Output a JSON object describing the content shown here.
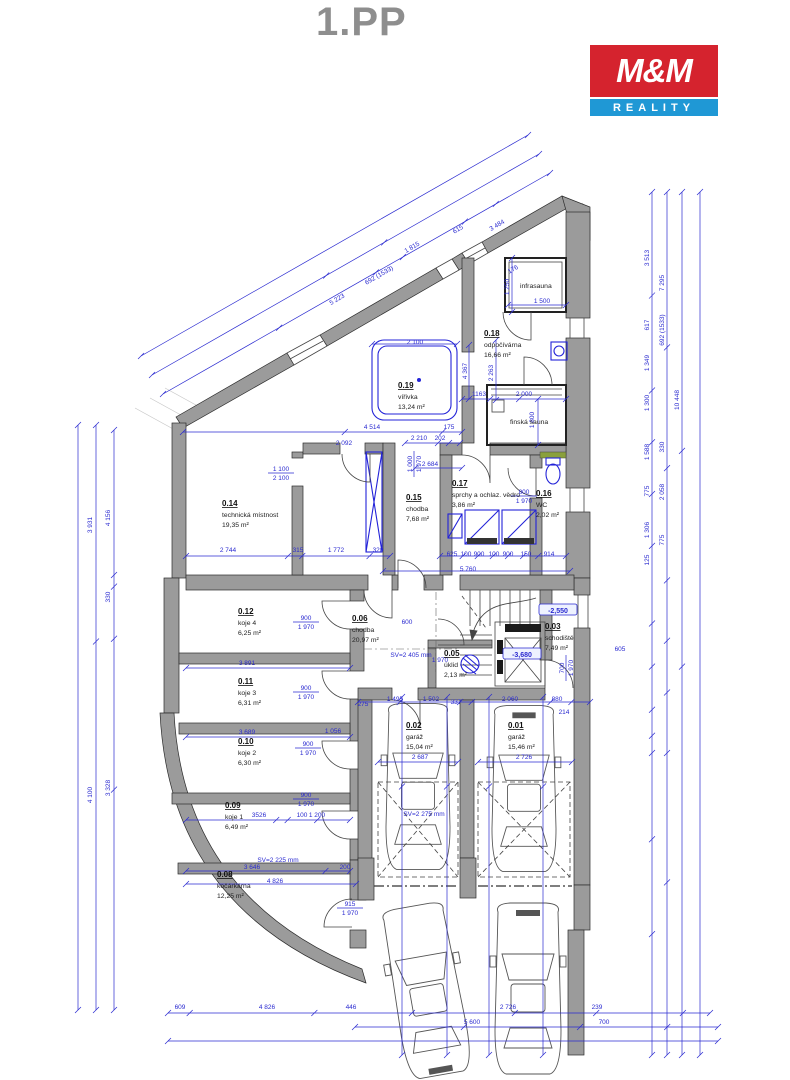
{
  "title": "1.PP",
  "logo": {
    "top": "M&M",
    "bottom": "REALITY",
    "red": "#d5232e",
    "blue": "#1f98d5"
  },
  "colors": {
    "wall": "#9b9b9b",
    "dimension": "#2a2ad0"
  },
  "rooms": [
    {
      "num": "0.19",
      "name": "vířivka",
      "area": "13,24 m²",
      "x": 398,
      "y": 388
    },
    {
      "num": "0.18",
      "name": "odpočívárna",
      "area": "16,66 m²",
      "x": 484,
      "y": 336
    },
    {
      "num": "",
      "name": "infrasauna",
      "area": "",
      "x": 520,
      "y": 288
    },
    {
      "num": "",
      "name": "finská sauna",
      "area": "",
      "x": 510,
      "y": 424
    },
    {
      "num": "0.14",
      "name": "technická místnost",
      "area": "19,35 m²",
      "x": 222,
      "y": 506
    },
    {
      "num": "0.15",
      "name": "chodba",
      "area": "7,68 m²",
      "x": 406,
      "y": 500
    },
    {
      "num": "0.17",
      "name": "sprchy a ochlaz. vědro",
      "area": "3,86 m²",
      "x": 452,
      "y": 486
    },
    {
      "num": "0.16",
      "name": "WC",
      "area": "2,02 m²",
      "x": 536,
      "y": 496
    },
    {
      "num": "0.12",
      "name": "koje 4",
      "area": "6,25 m²",
      "x": 238,
      "y": 614
    },
    {
      "num": "0.11",
      "name": "koje 3",
      "area": "6,31 m²",
      "x": 238,
      "y": 684
    },
    {
      "num": "0.10",
      "name": "koje 2",
      "area": "6,30 m²",
      "x": 238,
      "y": 744
    },
    {
      "num": "0.09",
      "name": "koje 1",
      "area": "6,49 m²",
      "x": 225,
      "y": 808
    },
    {
      "num": "0.08",
      "name": "kočárkárna",
      "area": "12,25 m²",
      "x": 217,
      "y": 877
    },
    {
      "num": "0.06",
      "name": "chodba",
      "area": "20,97 m²",
      "x": 352,
      "y": 621
    },
    {
      "num": "0.05",
      "name": "úklid",
      "area": "2,13 m²",
      "x": 444,
      "y": 656
    },
    {
      "num": "0.03",
      "name": "schodiště",
      "area": "7,49 m²",
      "x": 545,
      "y": 629
    },
    {
      "num": "0.02",
      "name": "garáž",
      "area": "15,04 m²",
      "x": 406,
      "y": 728
    },
    {
      "num": "0.01",
      "name": "garáž",
      "area": "15,46 m²",
      "x": 508,
      "y": 728
    }
  ],
  "levels": [
    {
      "text": "-2,550",
      "x": 558,
      "y": 612
    },
    {
      "text": "-3,680",
      "x": 522,
      "y": 656
    }
  ],
  "doors": [
    {
      "a": "900",
      "b": "1 970",
      "x": 306,
      "y": 620
    },
    {
      "a": "900",
      "b": "1 970",
      "x": 306,
      "y": 690
    },
    {
      "a": "900",
      "b": "1 970",
      "x": 308,
      "y": 746
    },
    {
      "a": "900",
      "b": "1 970",
      "x": 306,
      "y": 797
    },
    {
      "a": "915",
      "b": "1 970",
      "x": 350,
      "y": 906
    },
    {
      "a": "800",
      "b": "1 970",
      "x": 524,
      "y": 494
    },
    {
      "a": "1 100",
      "b": "2 100",
      "x": 281,
      "y": 471
    },
    {
      "a": "1 000",
      "b": "1 970",
      "x": 412,
      "y": 464,
      "r": -90
    },
    {
      "a": "700",
      "b": "1 970",
      "x": 564,
      "y": 668,
      "r": -90
    }
  ],
  "dims": [
    {
      "t": "1 815",
      "x": 413,
      "y": 249,
      "r": -30
    },
    {
      "t": "615",
      "x": 459,
      "y": 231,
      "r": -30
    },
    {
      "t": "3 484",
      "x": 498,
      "y": 227,
      "r": -30
    },
    {
      "t": "176",
      "x": 514,
      "y": 271,
      "r": -30
    },
    {
      "t": "692 (1533)",
      "x": 380,
      "y": 277,
      "r": -30
    },
    {
      "t": "5 223",
      "x": 338,
      "y": 301,
      "r": -30
    },
    {
      "t": "1 500",
      "x": 542,
      "y": 303
    },
    {
      "t": "1 250",
      "x": 509,
      "y": 287,
      "r": -90
    },
    {
      "t": "1163",
      "x": 479,
      "y": 396
    },
    {
      "t": "2 000",
      "x": 524,
      "y": 396
    },
    {
      "t": "2 263",
      "x": 493,
      "y": 373,
      "r": -90
    },
    {
      "t": "1 800",
      "x": 534,
      "y": 420,
      "r": -90
    },
    {
      "t": "2 100",
      "x": 415,
      "y": 344
    },
    {
      "t": "4 367",
      "x": 467,
      "y": 371,
      "r": -90
    },
    {
      "t": "4 514",
      "x": 372,
      "y": 429
    },
    {
      "t": "175",
      "x": 449,
      "y": 429
    },
    {
      "t": "2 210",
      "x": 419,
      "y": 440
    },
    {
      "t": "202",
      "x": 440,
      "y": 440
    },
    {
      "t": "2 684",
      "x": 430,
      "y": 466
    },
    {
      "t": "2 092",
      "x": 344,
      "y": 445
    },
    {
      "t": "2 744",
      "x": 228,
      "y": 552
    },
    {
      "t": "315",
      "x": 298,
      "y": 552
    },
    {
      "t": "1 772",
      "x": 336,
      "y": 552
    },
    {
      "t": "320",
      "x": 378,
      "y": 552
    },
    {
      "t": "625",
      "x": 452,
      "y": 556
    },
    {
      "t": "100",
      "x": 466,
      "y": 556
    },
    {
      "t": "900",
      "x": 479,
      "y": 556
    },
    {
      "t": "100",
      "x": 494,
      "y": 556
    },
    {
      "t": "900",
      "x": 508,
      "y": 556
    },
    {
      "t": "150",
      "x": 526,
      "y": 556
    },
    {
      "t": "914",
      "x": 549,
      "y": 556
    },
    {
      "t": "5 760",
      "x": 468,
      "y": 571
    },
    {
      "t": "3 891",
      "x": 247,
      "y": 665
    },
    {
      "t": "600",
      "x": 407,
      "y": 624
    },
    {
      "t": "605",
      "x": 620,
      "y": 651
    },
    {
      "t": "1 970",
      "x": 440,
      "y": 662
    },
    {
      "t": "3 689",
      "x": 247,
      "y": 734
    },
    {
      "t": "1 056",
      "x": 333,
      "y": 733
    },
    {
      "t": "3526",
      "x": 259,
      "y": 817
    },
    {
      "t": "100",
      "x": 302,
      "y": 817
    },
    {
      "t": "1 200",
      "x": 317,
      "y": 817
    },
    {
      "t": "3 646",
      "x": 252,
      "y": 869
    },
    {
      "t": "SV=2 225 mm",
      "x": 278,
      "y": 862
    },
    {
      "t": "4 826",
      "x": 275,
      "y": 883
    },
    {
      "t": "200",
      "x": 345,
      "y": 869
    },
    {
      "t": "SV=2 405 mm",
      "x": 411,
      "y": 657
    },
    {
      "t": "275",
      "x": 363,
      "y": 706
    },
    {
      "t": "1 495",
      "x": 395,
      "y": 701
    },
    {
      "t": "1 502",
      "x": 431,
      "y": 701
    },
    {
      "t": "337",
      "x": 456,
      "y": 704
    },
    {
      "t": "2 060",
      "x": 510,
      "y": 701
    },
    {
      "t": "880",
      "x": 557,
      "y": 701
    },
    {
      "t": "214",
      "x": 564,
      "y": 714
    },
    {
      "t": "2 687",
      "x": 420,
      "y": 759
    },
    {
      "t": "2 726",
      "x": 524,
      "y": 759
    },
    {
      "t": "SV=2 275 mm",
      "x": 424,
      "y": 816
    },
    {
      "t": "609",
      "x": 180,
      "y": 1009
    },
    {
      "t": "4 826",
      "x": 267,
      "y": 1009
    },
    {
      "t": "446",
      "x": 351,
      "y": 1009
    },
    {
      "t": "2 726",
      "x": 508,
      "y": 1009
    },
    {
      "t": "239",
      "x": 597,
      "y": 1009
    },
    {
      "t": "5 600",
      "x": 472,
      "y": 1024
    },
    {
      "t": "700",
      "x": 604,
      "y": 1024
    },
    {
      "t": "3 931",
      "x": 92,
      "y": 525,
      "r": -90
    },
    {
      "t": "4 100",
      "x": 92,
      "y": 795,
      "r": -90
    },
    {
      "t": "4 156",
      "x": 110,
      "y": 518,
      "r": -90
    },
    {
      "t": "330",
      "x": 110,
      "y": 597,
      "r": -90
    },
    {
      "t": "3 328",
      "x": 110,
      "y": 788,
      "r": -90
    },
    {
      "t": "3 513",
      "x": 649,
      "y": 258,
      "r": -90
    },
    {
      "t": "617",
      "x": 649,
      "y": 325,
      "r": -90
    },
    {
      "t": "1 349",
      "x": 649,
      "y": 363,
      "r": -90
    },
    {
      "t": "1 300",
      "x": 649,
      "y": 403,
      "r": -90
    },
    {
      "t": "1 588",
      "x": 649,
      "y": 452,
      "r": -90
    },
    {
      "t": "775",
      "x": 649,
      "y": 491,
      "r": -90
    },
    {
      "t": "1 306",
      "x": 649,
      "y": 530,
      "r": -90
    },
    {
      "t": "125",
      "x": 649,
      "y": 560,
      "r": -90
    },
    {
      "t": "7 295",
      "x": 664,
      "y": 283,
      "r": -90
    },
    {
      "t": "692 (1533)",
      "x": 664,
      "y": 330,
      "r": -90
    },
    {
      "t": "330",
      "x": 664,
      "y": 447,
      "r": -90
    },
    {
      "t": "2 058",
      "x": 664,
      "y": 492,
      "r": -90
    },
    {
      "t": "775",
      "x": 664,
      "y": 540,
      "r": -90
    },
    {
      "t": "10 448",
      "x": 679,
      "y": 400,
      "r": -90
    }
  ]
}
